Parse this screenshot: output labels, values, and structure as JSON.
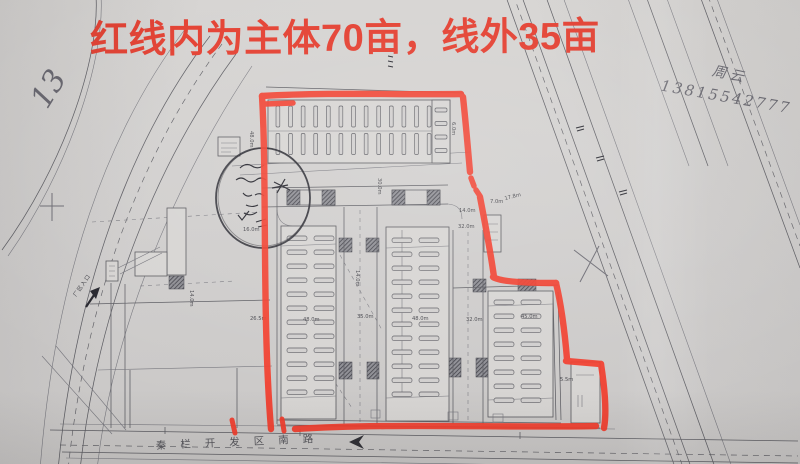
{
  "annotations": {
    "headline": "红线内为主体70亩，线外35亩",
    "handwritten_name": "周云",
    "handwritten_phone": "13815542777",
    "handwritten_number": "13",
    "entrance_label": "厂区入口",
    "road_name": "秦栏开发区南路"
  },
  "colors": {
    "marker_red": "#f23b2a",
    "headline_red": "#e33a2b",
    "plan_line_gray": "#5a5a60",
    "pencil_gray": "#6b6a72",
    "paper_gray": "#cecccb",
    "ink_black": "#23232b"
  },
  "dimensions": [
    {
      "text": "48.0m",
      "x": 303,
      "y": 321,
      "rot": 0
    },
    {
      "text": "35.0m",
      "x": 357,
      "y": 318,
      "rot": 0
    },
    {
      "text": "48.0m",
      "x": 412,
      "y": 320,
      "rot": 0
    },
    {
      "text": "32.0m",
      "x": 466,
      "y": 321,
      "rot": 0
    },
    {
      "text": "45.0m",
      "x": 521,
      "y": 318,
      "rot": 0
    },
    {
      "text": "6.0m",
      "x": 452,
      "y": 122,
      "rot": 90
    },
    {
      "text": "7.0m",
      "x": 490,
      "y": 203,
      "rot": 0
    },
    {
      "text": "17.8m",
      "x": 505,
      "y": 200,
      "rot": -14
    },
    {
      "text": "14.0m",
      "x": 459,
      "y": 212,
      "rot": 0
    },
    {
      "text": "32.0m",
      "x": 458,
      "y": 228,
      "rot": 0
    },
    {
      "text": "16.0m",
      "x": 243,
      "y": 231,
      "rot": 0
    },
    {
      "text": "26.5m",
      "x": 250,
      "y": 320,
      "rot": 0
    },
    {
      "text": "14.0m",
      "x": 190,
      "y": 290,
      "rot": 90
    },
    {
      "text": "14.0m",
      "x": 356,
      "y": 270,
      "rot": 90
    },
    {
      "text": "30.0m",
      "x": 378,
      "y": 178,
      "rot": 90
    },
    {
      "text": "48.0m",
      "x": 250,
      "y": 131,
      "rot": 90
    },
    {
      "text": "5.5m",
      "x": 560,
      "y": 381,
      "rot": 0
    }
  ]
}
